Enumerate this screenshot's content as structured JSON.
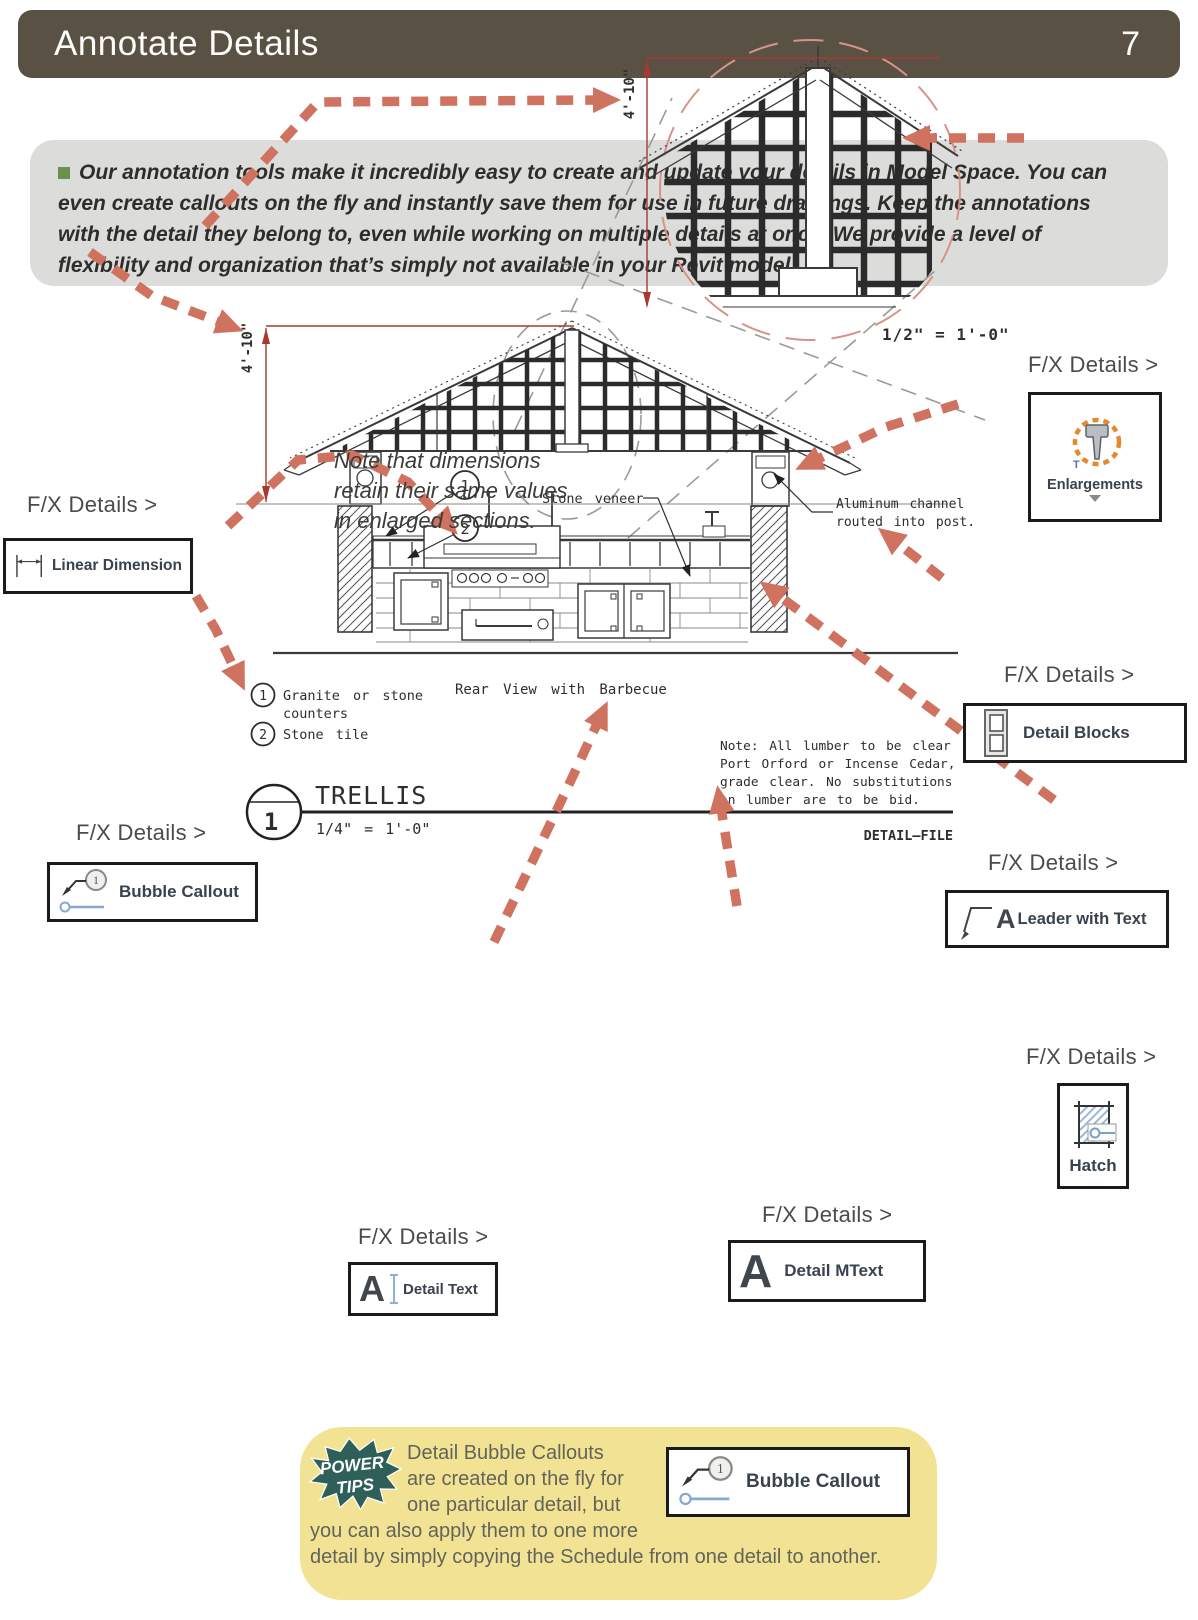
{
  "header": {
    "title": "Annotate Details",
    "page_number": "7"
  },
  "intro": {
    "text": "Our annotation tools make it incredibly easy to create and update your details in Model Space. You can even create callouts on the fly and instantly save them for use in future drawings. Keep the annotations with the detail they belong to, even while working on multiple details at once. We provide a level of flexibility and organization that’s simply not available in your Revit model."
  },
  "fx_label": "F/X Details >",
  "tools": {
    "linear_dimension": "Linear Dimension",
    "enlargements": "Enlargements",
    "detail_blocks": "Detail Blocks",
    "bubble_callout": "Bubble Callout",
    "leader_with_text": "Leader with Text",
    "hatch": "Hatch",
    "detail_mtext": "Detail MText",
    "detail_text": "Detail Text",
    "bubble_callout2": "Bubble Callout"
  },
  "note_dim": {
    "l1": "Note that dimensions",
    "l2": "retain their same values",
    "l3": "in enlarged sections."
  },
  "drawing": {
    "dim": "4'-10\"",
    "scale_enlarged": "1/2\" = 1'-0\"",
    "stone_veneer": "Stone veneer",
    "alum1": "Aluminum channel",
    "alum2": "routed into post.",
    "c1": "1",
    "c2": "2",
    "legend1a": "Granite or stone",
    "legend1b": "counters",
    "legend1_num": "1",
    "legend2": "Stone tile",
    "legend2_num": "2",
    "rear_view": "Rear View with Barbecue",
    "note1": "Note: All lumber to be clear",
    "note2": "Port Orford or Incense Cedar,",
    "note3": "grade clear. No substitutions",
    "note4": "on lumber are to be bid.",
    "title": "TRELLIS",
    "title_num": "1",
    "title_scale": "1/4\" = 1'-0\"",
    "detail_file": "DETAIL—FILE"
  },
  "power_tips": {
    "badge_line1": "POWER",
    "badge_line2": "TIPS",
    "lines": [
      "Detail Bubble Callouts",
      "are created on the fly for",
      "one particular detail, but",
      "you can also apply them to one more",
      "detail by simply copying the Schedule from one detail to another."
    ]
  },
  "colors": {
    "header_bg": "#5a5145",
    "intro_bg": "#dcdcda",
    "arrow_salmon": "#cf7260",
    "dim_red": "#a8392e",
    "tips_yellow": "#f2e394",
    "badge_teal": "#2e6059",
    "bullet_green": "#6d8f4e"
  }
}
